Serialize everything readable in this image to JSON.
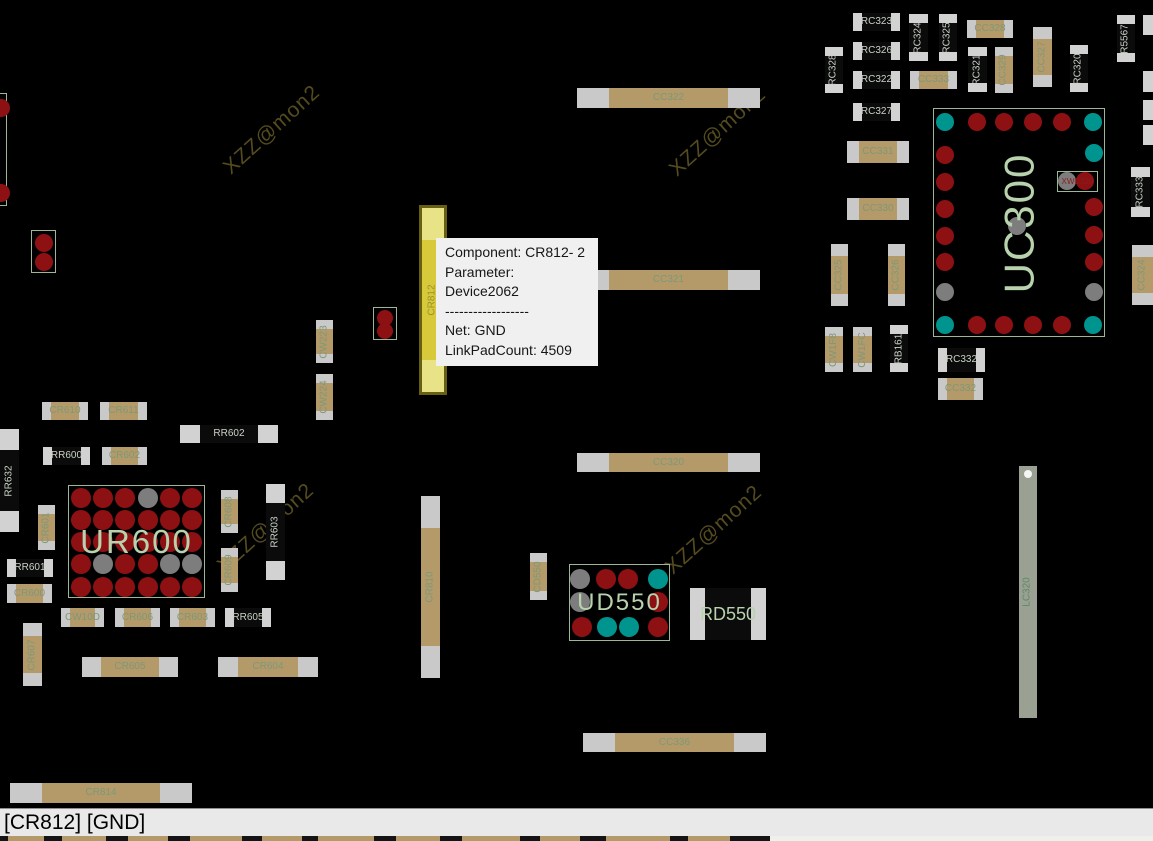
{
  "app": {
    "kind": "pcb-net-viewer"
  },
  "colors": {
    "board_bg": "#000000",
    "cap_body": "#b49a69",
    "cap_pad": "#c9c9c9",
    "cap_label": "#7d9879",
    "res_body": "#0b0b0b",
    "res_pad": "#d2d2d2",
    "res_label": "#c9d2c6",
    "pad_red": "#8d1013",
    "pad_teal": "#00948f",
    "pad_gray": "#7d7d7d",
    "chip_outline": "#9cb795",
    "chip_label": "#b7d2ac",
    "sub_label": "#8a1d1d",
    "highlight_body": "#d7c93a",
    "highlight_pad": "#e9e388",
    "highlight_border": "#666010",
    "highlight_label": "#9a912d",
    "bar_body": "#9aa092",
    "bar_label": "#5c8a64",
    "bar_dot": "#f5f5f5",
    "watermark": "#544b1e",
    "tooltip_bg": "#f0f0f0",
    "tooltip_text": "#161616",
    "status_bg": "#e9e9e9",
    "status_text": "#000000",
    "status_border": "#8f8f8f",
    "strip_dark": "#141414",
    "strip_light": "#eef1ea",
    "strip_tan": "#b49a69"
  },
  "tooltip": {
    "x": 436,
    "y": 238,
    "w": 162,
    "lines": [
      "Component: CR812- 2",
      "Parameter: Device2062",
      "------------------",
      "Net: GND",
      "LinkPadCount: 4509"
    ]
  },
  "status_bar": {
    "text": "[CR812] [GND]"
  },
  "watermark": {
    "text": "XZZ@mon2",
    "positions": [
      [
        272,
        130
      ],
      [
        718,
        132
      ],
      [
        266,
        528
      ],
      [
        714,
        530
      ]
    ]
  },
  "components": [
    {
      "ref": "RC323",
      "k": "res",
      "x": 853,
      "y": 13,
      "w": 47,
      "h": 18,
      "v": false
    },
    {
      "ref": "RC326",
      "k": "res",
      "x": 853,
      "y": 42,
      "w": 47,
      "h": 18,
      "v": false
    },
    {
      "ref": "RC322",
      "k": "res",
      "x": 853,
      "y": 71,
      "w": 47,
      "h": 18,
      "v": false
    },
    {
      "ref": "RC327",
      "k": "res",
      "x": 853,
      "y": 103,
      "w": 47,
      "h": 18,
      "v": false
    },
    {
      "ref": "RC328",
      "k": "res",
      "x": 825,
      "y": 47,
      "w": 18,
      "h": 46,
      "v": true
    },
    {
      "ref": "RC324",
      "k": "res",
      "x": 909,
      "y": 14,
      "w": 19,
      "h": 47,
      "v": true
    },
    {
      "ref": "RC325",
      "k": "res",
      "x": 939,
      "y": 14,
      "w": 18,
      "h": 47,
      "v": true
    },
    {
      "ref": "RC321",
      "k": "res",
      "x": 968,
      "y": 47,
      "w": 19,
      "h": 45,
      "v": true
    },
    {
      "ref": "RC320",
      "k": "res",
      "x": 1070,
      "y": 45,
      "w": 18,
      "h": 47,
      "v": true
    },
    {
      "ref": "R5567",
      "k": "res",
      "x": 1117,
      "y": 15,
      "w": 18,
      "h": 47,
      "v": true
    },
    {
      "ref": "RC333",
      "k": "res",
      "x": 1131,
      "y": 167,
      "w": 19,
      "h": 50,
      "v": true
    },
    {
      "ref": "RB161",
      "k": "res",
      "x": 890,
      "y": 325,
      "w": 18,
      "h": 47,
      "v": true
    },
    {
      "ref": "RC332",
      "k": "res",
      "x": 938,
      "y": 348,
      "w": 47,
      "h": 24,
      "v": false
    },
    {
      "ref": "RR632",
      "k": "res",
      "x": 0,
      "y": 429,
      "w": 19,
      "h": 103,
      "v": true
    },
    {
      "ref": "RR602",
      "k": "res",
      "x": 180,
      "y": 425,
      "w": 98,
      "h": 18,
      "v": false
    },
    {
      "ref": "RR600",
      "k": "res",
      "x": 43,
      "y": 447,
      "w": 47,
      "h": 18,
      "v": false
    },
    {
      "ref": "RR601",
      "k": "res",
      "x": 7,
      "y": 559,
      "w": 46,
      "h": 18,
      "v": false
    },
    {
      "ref": "RR603",
      "k": "res",
      "x": 266,
      "y": 484,
      "w": 19,
      "h": 96,
      "v": true
    },
    {
      "ref": "RR605",
      "k": "res",
      "x": 225,
      "y": 608,
      "w": 46,
      "h": 19,
      "v": false
    },
    {
      "ref": "CC328",
      "k": "cap",
      "x": 967,
      "y": 20,
      "w": 46,
      "h": 18,
      "v": false
    },
    {
      "ref": "CC333",
      "k": "cap",
      "x": 910,
      "y": 71,
      "w": 47,
      "h": 18,
      "v": false
    },
    {
      "ref": "CC329",
      "k": "cap",
      "x": 995,
      "y": 47,
      "w": 18,
      "h": 46,
      "v": true
    },
    {
      "ref": "CC327",
      "k": "cap",
      "x": 1033,
      "y": 27,
      "w": 19,
      "h": 60,
      "v": true
    },
    {
      "ref": "CC331",
      "k": "cap",
      "x": 847,
      "y": 141,
      "w": 62,
      "h": 22,
      "v": false
    },
    {
      "ref": "CC330",
      "k": "cap",
      "x": 847,
      "y": 198,
      "w": 62,
      "h": 22,
      "v": false
    },
    {
      "ref": "CC325",
      "k": "cap",
      "x": 831,
      "y": 244,
      "w": 17,
      "h": 62,
      "v": true
    },
    {
      "ref": "CC326",
      "k": "cap",
      "x": 888,
      "y": 244,
      "w": 17,
      "h": 62,
      "v": true
    },
    {
      "ref": "CW1F8",
      "k": "cap",
      "x": 825,
      "y": 327,
      "w": 18,
      "h": 45,
      "v": true
    },
    {
      "ref": "CW1FC",
      "k": "cap",
      "x": 853,
      "y": 327,
      "w": 19,
      "h": 45,
      "v": true
    },
    {
      "ref": "CC332",
      "k": "cap",
      "x": 938,
      "y": 378,
      "w": 45,
      "h": 22,
      "v": false
    },
    {
      "ref": "CC324",
      "k": "cap",
      "x": 1132,
      "y": 245,
      "w": 21,
      "h": 60,
      "v": true
    },
    {
      "ref": "CC322",
      "k": "cap",
      "x": 577,
      "y": 88,
      "w": 183,
      "h": 20,
      "v": false
    },
    {
      "ref": "CC321",
      "k": "cap",
      "x": 577,
      "y": 270,
      "w": 183,
      "h": 20,
      "v": false
    },
    {
      "ref": "CC320",
      "k": "cap",
      "x": 577,
      "y": 453,
      "w": 183,
      "h": 19,
      "v": false
    },
    {
      "ref": "CC336",
      "k": "cap",
      "x": 583,
      "y": 733,
      "w": 183,
      "h": 19,
      "v": false
    },
    {
      "ref": "CR814",
      "k": "cap",
      "x": 10,
      "y": 783,
      "w": 182,
      "h": 20,
      "v": false
    },
    {
      "ref": "CW223",
      "k": "cap",
      "x": 316,
      "y": 320,
      "w": 17,
      "h": 43,
      "v": true
    },
    {
      "ref": "CW224",
      "k": "cap",
      "x": 316,
      "y": 374,
      "w": 17,
      "h": 46,
      "v": true
    },
    {
      "ref": "CR610",
      "k": "cap",
      "x": 42,
      "y": 402,
      "w": 46,
      "h": 18,
      "v": false
    },
    {
      "ref": "CR611",
      "k": "cap",
      "x": 100,
      "y": 402,
      "w": 47,
      "h": 18,
      "v": false
    },
    {
      "ref": "CR602",
      "k": "cap",
      "x": 102,
      "y": 447,
      "w": 45,
      "h": 18,
      "v": false
    },
    {
      "ref": "CR601",
      "k": "cap",
      "x": 38,
      "y": 505,
      "w": 17,
      "h": 45,
      "v": true
    },
    {
      "ref": "CR608",
      "k": "cap",
      "x": 221,
      "y": 490,
      "w": 17,
      "h": 43,
      "v": true
    },
    {
      "ref": "CR609",
      "k": "cap",
      "x": 221,
      "y": 548,
      "w": 17,
      "h": 44,
      "v": true
    },
    {
      "ref": "CR600",
      "k": "cap",
      "x": 7,
      "y": 584,
      "w": 45,
      "h": 19,
      "v": false
    },
    {
      "ref": "CW10D",
      "k": "cap",
      "x": 61,
      "y": 608,
      "w": 43,
      "h": 19,
      "v": false
    },
    {
      "ref": "CR606",
      "k": "cap",
      "x": 115,
      "y": 608,
      "w": 45,
      "h": 19,
      "v": false
    },
    {
      "ref": "CR603",
      "k": "cap",
      "x": 170,
      "y": 608,
      "w": 45,
      "h": 19,
      "v": false
    },
    {
      "ref": "CR607",
      "k": "cap",
      "x": 23,
      "y": 623,
      "w": 19,
      "h": 63,
      "v": true
    },
    {
      "ref": "CR605",
      "k": "cap",
      "x": 82,
      "y": 657,
      "w": 96,
      "h": 20,
      "v": false
    },
    {
      "ref": "CR604",
      "k": "cap",
      "x": 218,
      "y": 657,
      "w": 100,
      "h": 20,
      "v": false
    },
    {
      "ref": "CR810",
      "k": "cap",
      "x": 421,
      "y": 496,
      "w": 19,
      "h": 182,
      "v": true
    },
    {
      "ref": "CD550",
      "k": "cap",
      "x": 530,
      "y": 553,
      "w": 17,
      "h": 47,
      "v": true
    },
    {
      "ref": "CR812",
      "k": "hl",
      "x": 419,
      "y": 205,
      "w": 28,
      "h": 190,
      "v": true
    },
    {
      "ref": "LC320",
      "k": "bar",
      "x": 1019,
      "y": 466,
      "w": 18,
      "h": 252,
      "v": true
    },
    {
      "ref": "RD550",
      "k": "ic",
      "x": 690,
      "y": 588,
      "w": 76,
      "h": 52,
      "v": false,
      "fs": 18
    }
  ],
  "chips": [
    {
      "ref": "UC300",
      "x": 933,
      "y": 108,
      "w": 172,
      "h": 229,
      "fs": 42,
      "rot": true,
      "r": 9,
      "pads": [
        [
          944,
          121,
          "t"
        ],
        [
          976,
          121,
          "r"
        ],
        [
          1003,
          121,
          "r"
        ],
        [
          1032,
          121,
          "r"
        ],
        [
          1061,
          121,
          "r"
        ],
        [
          1092,
          121,
          "t"
        ],
        [
          944,
          154,
          "r"
        ],
        [
          1093,
          152,
          "t"
        ],
        [
          944,
          181,
          "r"
        ],
        [
          944,
          208,
          "r"
        ],
        [
          1093,
          206,
          "r"
        ],
        [
          944,
          235,
          "r"
        ],
        [
          1093,
          234,
          "r"
        ],
        [
          944,
          261,
          "r"
        ],
        [
          1093,
          261,
          "r"
        ],
        [
          944,
          291,
          "g"
        ],
        [
          1093,
          291,
          "g"
        ],
        [
          1016,
          225,
          "g"
        ],
        [
          944,
          324,
          "t"
        ],
        [
          976,
          324,
          "r"
        ],
        [
          1003,
          324,
          "r"
        ],
        [
          1032,
          324,
          "r"
        ],
        [
          1061,
          324,
          "r"
        ],
        [
          1092,
          324,
          "t"
        ],
        [
          1066,
          180,
          "g"
        ],
        [
          1084,
          180,
          "r"
        ]
      ],
      "sub": {
        "ref": "XWC320",
        "x": 1056,
        "y": 170,
        "w": 41,
        "h": 21
      }
    },
    {
      "ref": "UR600",
      "x": 68,
      "y": 485,
      "w": 137,
      "h": 113,
      "fs": 33,
      "rot": false,
      "r": 10,
      "grid": {
        "cols": [
          80,
          102,
          124,
          147,
          169,
          191
        ],
        "rows": [
          497,
          519,
          541,
          563,
          586
        ],
        "colors": [
          "rrrgrr",
          "rrrrrr",
          "rrrrrr",
          "rgrrgg",
          "rrrrrr"
        ]
      },
      "pads": []
    },
    {
      "ref": "UD550",
      "x": 569,
      "y": 564,
      "w": 101,
      "h": 77,
      "fs": 24,
      "rot": false,
      "r": 10,
      "pads": [
        [
          579,
          578,
          "g"
        ],
        [
          605,
          578,
          "r"
        ],
        [
          627,
          578,
          "r"
        ],
        [
          657,
          578,
          "t"
        ],
        [
          579,
          601,
          "g"
        ],
        [
          657,
          601,
          "r"
        ],
        [
          581,
          626,
          "r"
        ],
        [
          606,
          626,
          "t"
        ],
        [
          628,
          626,
          "t"
        ],
        [
          657,
          626,
          "r"
        ]
      ]
    }
  ],
  "pad_pairs": [
    {
      "x": -14,
      "y": 93,
      "w": 21,
      "h": 113,
      "pads": [
        [
          0,
          107,
          9
        ],
        [
          0,
          192,
          9
        ]
      ]
    },
    {
      "x": 31,
      "y": 230,
      "w": 25,
      "h": 43,
      "pads": [
        [
          43,
          242,
          9
        ],
        [
          43,
          261,
          9
        ]
      ]
    },
    {
      "x": 373,
      "y": 307,
      "w": 24,
      "h": 33,
      "pads": [
        [
          384,
          317,
          8
        ],
        [
          384,
          330,
          8
        ]
      ]
    }
  ],
  "stubs": [
    [
      1143,
      15,
      10,
      20
    ],
    [
      1143,
      71,
      10,
      21
    ],
    [
      1143,
      100,
      10,
      20
    ],
    [
      1143,
      125,
      10,
      20
    ]
  ],
  "bottom_strip": {
    "split": 770,
    "segments": [
      [
        8,
        36
      ],
      [
        62,
        44
      ],
      [
        128,
        40
      ],
      [
        190,
        52
      ],
      [
        262,
        40
      ],
      [
        318,
        56
      ],
      [
        396,
        44
      ],
      [
        462,
        58
      ],
      [
        540,
        40
      ],
      [
        606,
        64
      ],
      [
        688,
        42
      ]
    ]
  }
}
